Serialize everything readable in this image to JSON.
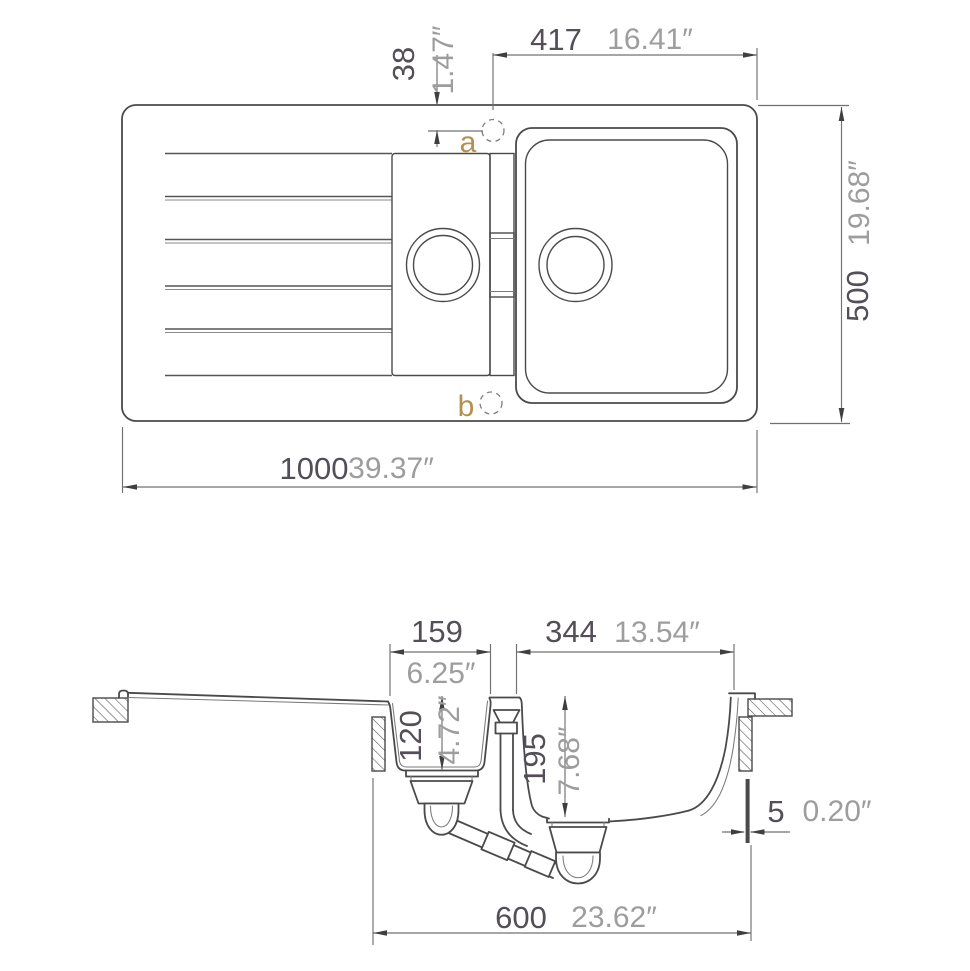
{
  "drawing": {
    "top_view": {
      "overall_width": {
        "mm": "1000",
        "inch": "39.37″"
      },
      "overall_depth": {
        "mm": "500",
        "inch": "19.68″"
      },
      "bowl_section_width": {
        "mm": "417",
        "inch": "16.41″"
      },
      "tap_hole_offset": {
        "mm": "38",
        "inch": "1.47″"
      },
      "tap_hole_labels": {
        "a": "a",
        "b": "b"
      }
    },
    "section_view": {
      "half_bowl_width": {
        "mm": "159",
        "inch": "6.25″"
      },
      "main_bowl_width": {
        "mm": "344",
        "inch": "13.54″"
      },
      "half_bowl_depth": {
        "mm": "120",
        "inch": "4.72″"
      },
      "main_bowl_depth": {
        "mm": "195",
        "inch": "7.68″"
      },
      "rim_lip_thickness": {
        "mm": "5",
        "inch": "0.20″"
      },
      "cabinet_width": {
        "mm": "600",
        "inch": "23.62″"
      }
    },
    "colors": {
      "line": "#4a4a4a",
      "dimension_line": "#707070",
      "mm_text": "#534e57",
      "inch_text": "#9d9d9d",
      "label_text": "#b3904f",
      "background": "#ffffff"
    }
  }
}
